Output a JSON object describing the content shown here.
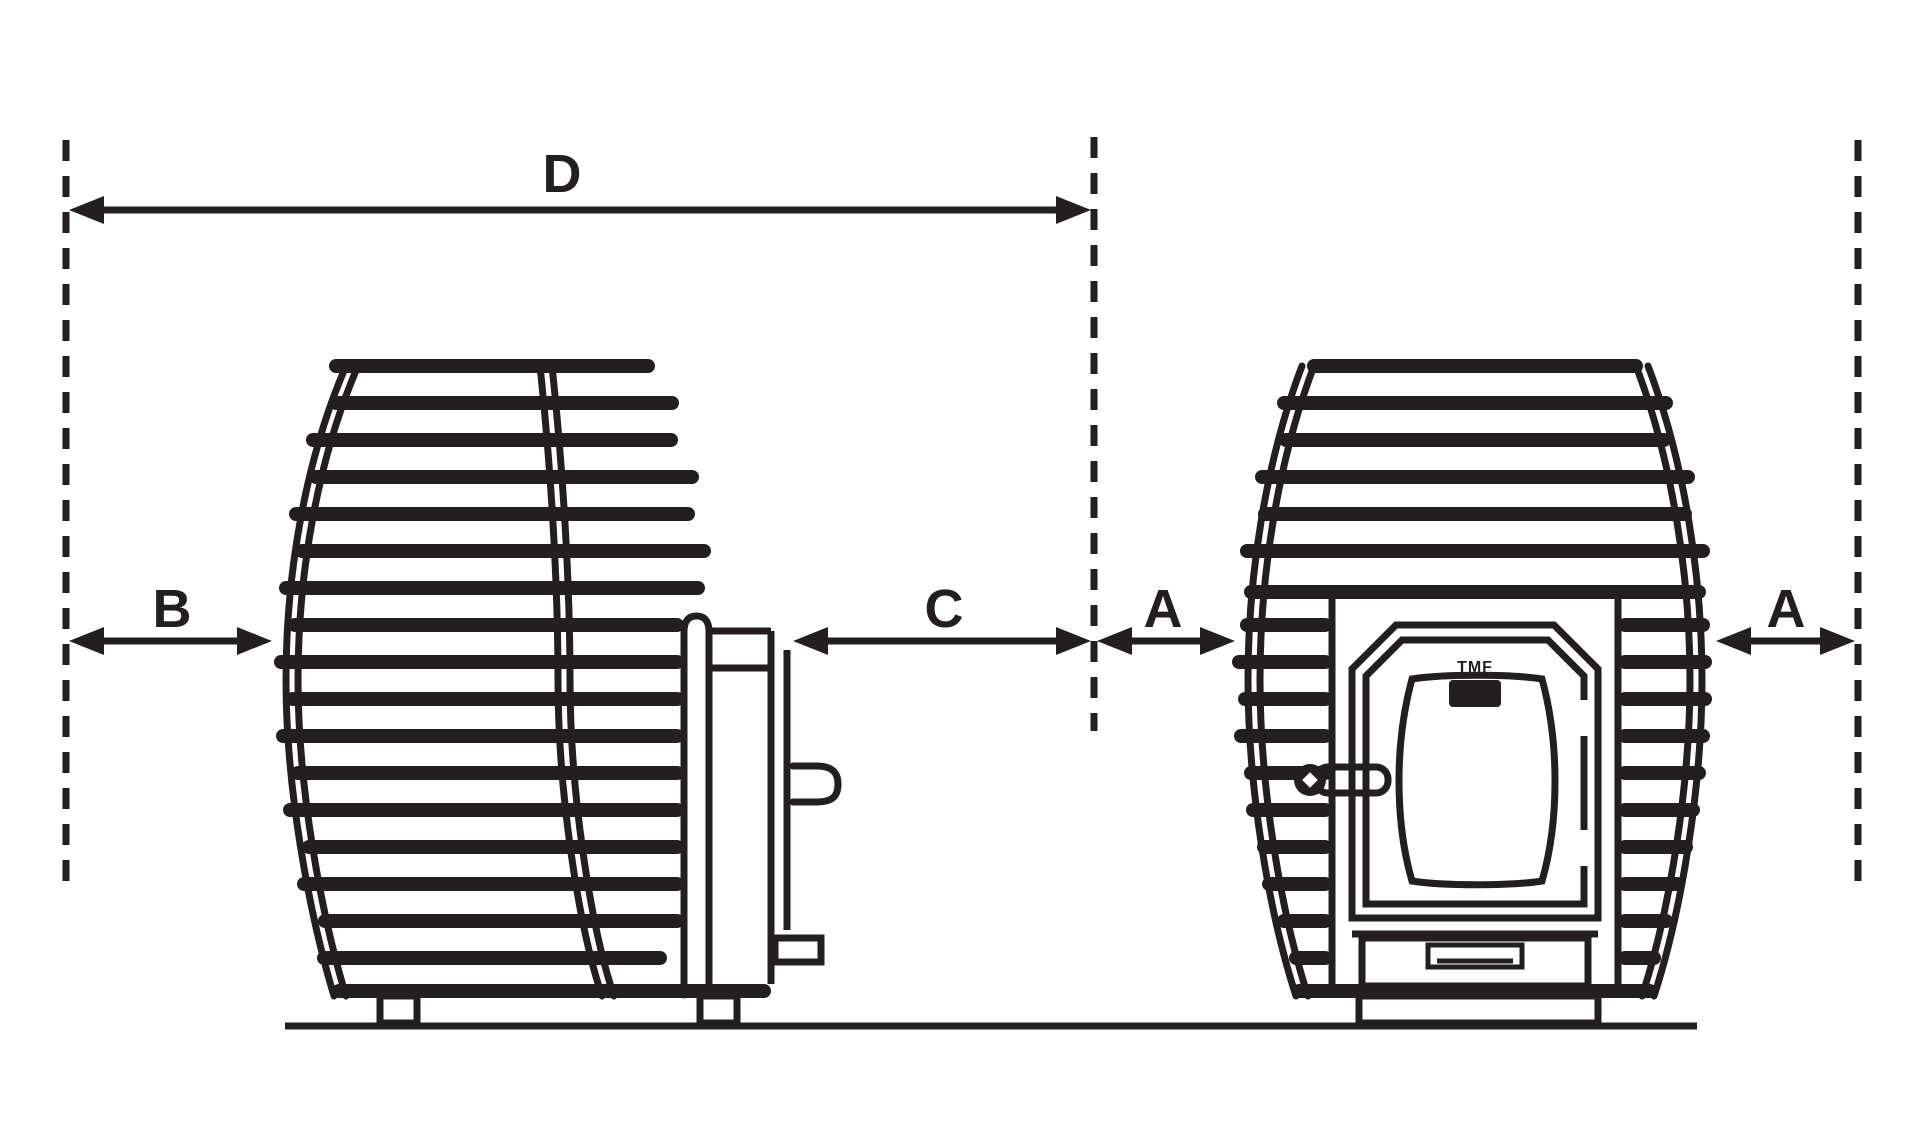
{
  "diagram": {
    "colors": {
      "ink": "#231f20",
      "background": "#ffffff"
    },
    "dimensions": {
      "d_label": "D",
      "b_label": "B",
      "c_label": "C",
      "a_middle_label": "A",
      "a_right_label": "A"
    },
    "door_logo_text": "TMF"
  }
}
